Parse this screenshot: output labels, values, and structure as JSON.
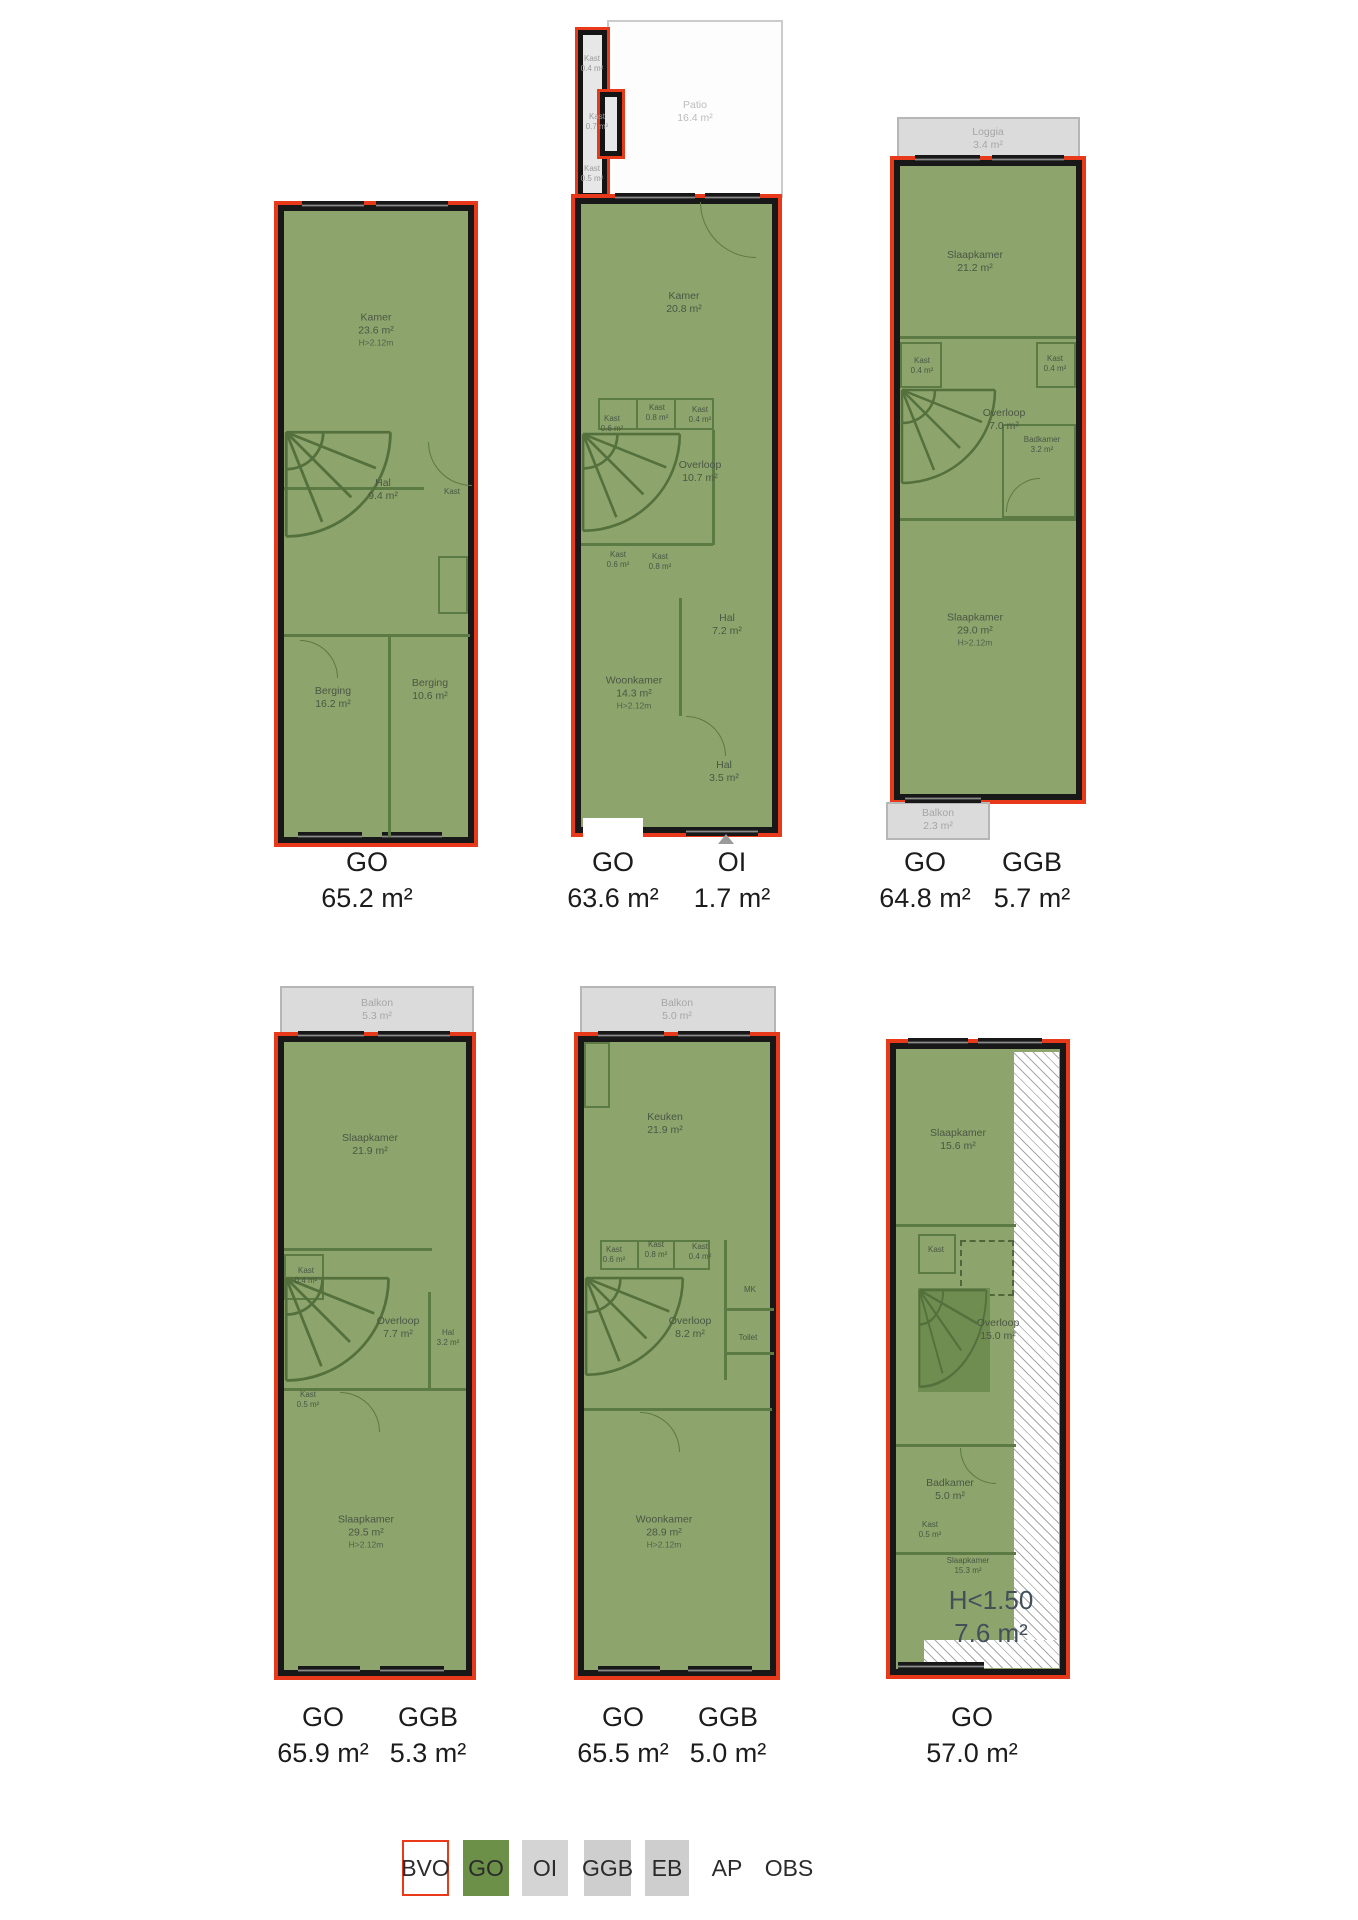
{
  "colors": {
    "go_fill": "#8da46c",
    "go_swatch": "#6c9048",
    "bvo_outline": "#e8391b",
    "wall": "#181818",
    "gray_area": "#dbdbdb",
    "height_note": "#43505a"
  },
  "plans": [
    {
      "name": "floor-1",
      "rooms": [
        {
          "name": "Kamer",
          "area": "23.6 m²",
          "sub": "H>2.12m"
        },
        {
          "name": "Hal",
          "area": "9.4 m²"
        },
        {
          "name": "Kast",
          "area": ""
        },
        {
          "name": "Berging",
          "area": "16.2 m²"
        },
        {
          "name": "Berging",
          "area": "10.6 m²"
        }
      ],
      "totals": [
        {
          "code": "GO",
          "value": "65.2 m²"
        }
      ]
    },
    {
      "name": "floor-2",
      "patio": {
        "name": "Patio",
        "area": "16.4 m²"
      },
      "rooms": [
        {
          "name": "Kast",
          "area": "0.4 m²"
        },
        {
          "name": "Kast",
          "area": "0.7 m²"
        },
        {
          "name": "Kast",
          "area": "0.5 m²"
        },
        {
          "name": "Kamer",
          "area": "20.8 m²"
        },
        {
          "name": "Kast",
          "area": "0.6 m²"
        },
        {
          "name": "Kast",
          "area": "0.8 m²"
        },
        {
          "name": "Kast",
          "area": "0.4 m²"
        },
        {
          "name": "Overloop",
          "area": "10.7 m²"
        },
        {
          "name": "Kast",
          "area": "0.6 m²"
        },
        {
          "name": "Kast",
          "area": "0.8 m²"
        },
        {
          "name": "Hal",
          "area": "7.2 m²"
        },
        {
          "name": "Woonkamer",
          "area": "14.3 m²",
          "sub": "H>2.12m"
        },
        {
          "name": "Hal",
          "area": "3.5 m²"
        }
      ],
      "totals": [
        {
          "code": "GO",
          "value": "63.6 m²"
        },
        {
          "code": "OI",
          "value": "1.7 m²"
        }
      ]
    },
    {
      "name": "floor-3",
      "loggia": {
        "name": "Loggia",
        "area": "3.4 m²"
      },
      "balkon": {
        "name": "Balkon",
        "area": "2.3 m²"
      },
      "rooms": [
        {
          "name": "Slaapkamer",
          "area": "21.2 m²"
        },
        {
          "name": "Kast",
          "area": "0.4 m²"
        },
        {
          "name": "Kast",
          "area": "0.4 m²"
        },
        {
          "name": "Overloop",
          "area": "7.0 m²"
        },
        {
          "name": "Badkamer",
          "area": "3.2 m²"
        },
        {
          "name": "Slaapkamer",
          "area": "29.0 m²",
          "sub": "H>2.12m"
        }
      ],
      "totals": [
        {
          "code": "GO",
          "value": "64.8 m²"
        },
        {
          "code": "GGB",
          "value": "5.7 m²"
        }
      ]
    },
    {
      "name": "floor-4",
      "balkon": {
        "name": "Balkon",
        "area": "5.3 m²"
      },
      "rooms": [
        {
          "name": "Slaapkamer",
          "area": "21.9 m²"
        },
        {
          "name": "Kast",
          "area": "0.4 m²"
        },
        {
          "name": "Overloop",
          "area": "7.7 m²"
        },
        {
          "name": "Hal",
          "area": "3.2 m²"
        },
        {
          "name": "Kast",
          "area": "0.5 m²"
        },
        {
          "name": "Slaapkamer",
          "area": "29.5 m²",
          "sub": "H>2.12m"
        }
      ],
      "totals": [
        {
          "code": "GO",
          "value": "65.9 m²"
        },
        {
          "code": "GGB",
          "value": "5.3 m²"
        }
      ]
    },
    {
      "name": "floor-5",
      "balkon": {
        "name": "Balkon",
        "area": "5.0 m²"
      },
      "rooms": [
        {
          "name": "Keuken",
          "area": "21.9 m²"
        },
        {
          "name": "Kast",
          "area": "0.6 m²"
        },
        {
          "name": "Kast",
          "area": "0.8 m²"
        },
        {
          "name": "Kast",
          "area": "0.4 m²"
        },
        {
          "name": "Overloop",
          "area": "8.2 m²"
        },
        {
          "name": "MK",
          "area": ""
        },
        {
          "name": "Toilet",
          "area": ""
        },
        {
          "name": "Woonkamer",
          "area": "28.9 m²",
          "sub": "H>2.12m"
        }
      ],
      "totals": [
        {
          "code": "GO",
          "value": "65.5 m²"
        },
        {
          "code": "GGB",
          "value": "5.0 m²"
        }
      ]
    },
    {
      "name": "floor-6",
      "rooms": [
        {
          "name": "Slaapkamer",
          "area": "15.6 m²"
        },
        {
          "name": "Kast",
          "area": ""
        },
        {
          "name": "Overloop",
          "area": "15.0 m²"
        },
        {
          "name": "Badkamer",
          "area": "5.0 m²"
        },
        {
          "name": "Kast",
          "area": "0.5 m²"
        },
        {
          "name": "Slaapkamer",
          "area": "15.3 m²"
        }
      ],
      "height_note": {
        "line1": "H<1.50",
        "line2": "7.6 m²"
      },
      "totals": [
        {
          "code": "GO",
          "value": "57.0 m²"
        }
      ]
    }
  ],
  "legend": {
    "items": [
      {
        "label": "BVO",
        "swatch": "bvo"
      },
      {
        "label": "GO",
        "swatch": "go"
      },
      {
        "label": "OI",
        "swatch": "oi"
      },
      {
        "label": "GGB",
        "swatch": "ggb"
      },
      {
        "label": "EB",
        "swatch": "eb"
      },
      {
        "label": "AP",
        "swatch": "none"
      },
      {
        "label": "OBS",
        "swatch": "none"
      }
    ]
  }
}
